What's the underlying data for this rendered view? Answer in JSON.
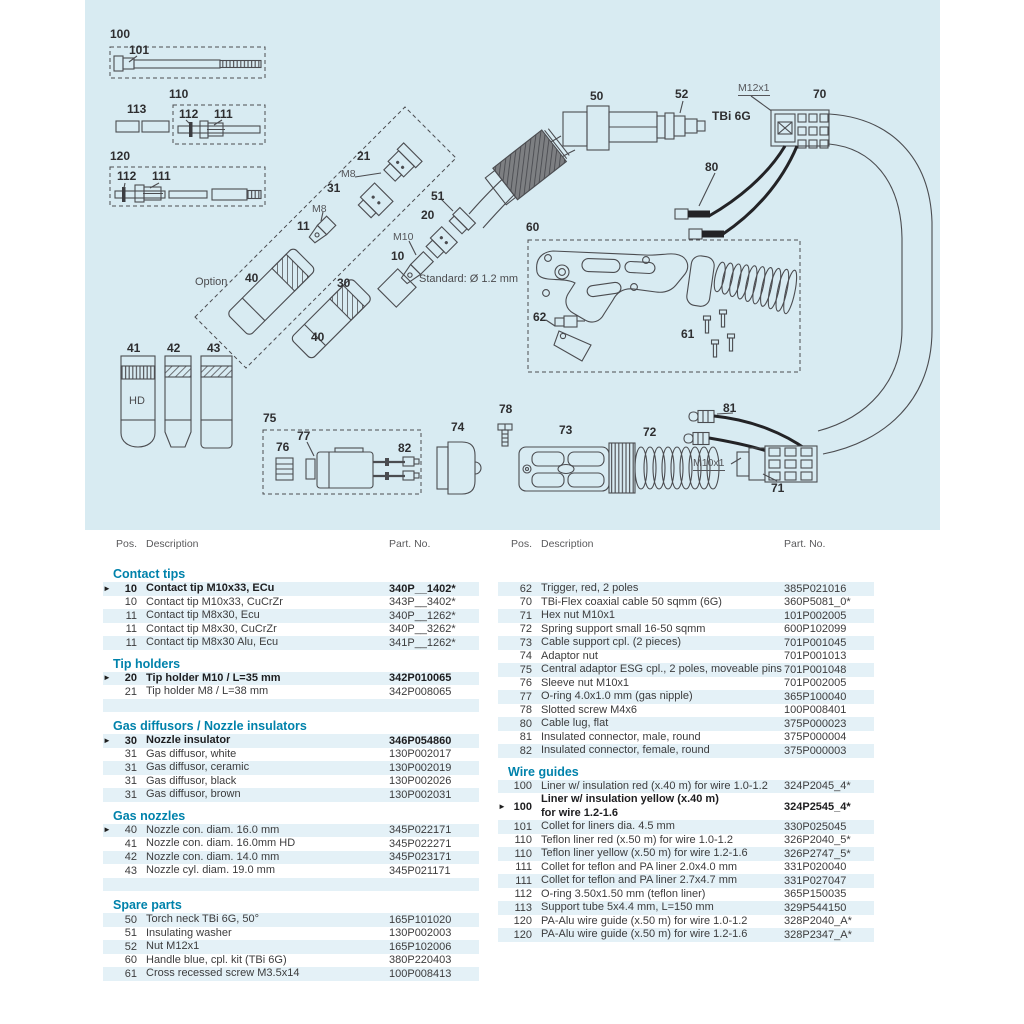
{
  "colors": {
    "panel_bg": "#d8ebf2",
    "accent": "#0082ab",
    "row_shade": "#e4f1f7",
    "line": "#4b4c50",
    "text": "#3c3c3d"
  },
  "arrow_char": "►",
  "diagram": {
    "labels": [
      {
        "text": "100",
        "x": 25,
        "y": 28,
        "cls": "b"
      },
      {
        "text": "101",
        "x": 44,
        "y": 44,
        "cls": "b"
      },
      {
        "text": "113",
        "x": 42,
        "y": 103,
        "cls": "b"
      },
      {
        "text": "110",
        "x": 84,
        "y": 88,
        "cls": "b"
      },
      {
        "text": "112",
        "x": 94,
        "y": 108,
        "cls": "b"
      },
      {
        "text": "111",
        "x": 129,
        "y": 108,
        "cls": "b"
      },
      {
        "text": "120",
        "x": 25,
        "y": 150,
        "cls": "b"
      },
      {
        "text": "112",
        "x": 32,
        "y": 170,
        "cls": "b"
      },
      {
        "text": "111",
        "x": 67,
        "y": 170,
        "cls": "b"
      },
      {
        "text": "21",
        "x": 272,
        "y": 150,
        "cls": "b"
      },
      {
        "text": "M8",
        "x": 256,
        "y": 169,
        "cls": "s"
      },
      {
        "text": "31",
        "x": 242,
        "y": 182,
        "cls": "b"
      },
      {
        "text": "M8",
        "x": 227,
        "y": 204,
        "cls": "s"
      },
      {
        "text": "11",
        "x": 212,
        "y": 220,
        "cls": "b"
      },
      {
        "text": "Option",
        "x": 110,
        "y": 277,
        "cls": "g"
      },
      {
        "text": "40",
        "x": 160,
        "y": 272,
        "cls": "b"
      },
      {
        "text": "30",
        "x": 252,
        "y": 277,
        "cls": "b"
      },
      {
        "text": "40",
        "x": 226,
        "y": 331,
        "cls": "b"
      },
      {
        "text": "10",
        "x": 306,
        "y": 250,
        "cls": "b"
      },
      {
        "text": "M10",
        "x": 308,
        "y": 232,
        "cls": "s"
      },
      {
        "text": "20",
        "x": 336,
        "y": 209,
        "cls": "b"
      },
      {
        "text": "51",
        "x": 346,
        "y": 190,
        "cls": "b"
      },
      {
        "text": "Standard: Ø 1.2 mm",
        "x": 334,
        "y": 274,
        "cls": "g"
      },
      {
        "text": "50",
        "x": 505,
        "y": 90,
        "cls": "b"
      },
      {
        "text": "52",
        "x": 590,
        "y": 88,
        "cls": "b"
      },
      {
        "text": "TBi 6G",
        "x": 627,
        "y": 110,
        "cls": "b"
      },
      {
        "text": "M12x1",
        "x": 653,
        "y": 83,
        "cls": "s u"
      },
      {
        "text": "70",
        "x": 728,
        "y": 88,
        "cls": "b"
      },
      {
        "text": "80",
        "x": 620,
        "y": 161,
        "cls": "b"
      },
      {
        "text": "60",
        "x": 441,
        "y": 221,
        "cls": "b"
      },
      {
        "text": "62",
        "x": 448,
        "y": 311,
        "cls": "b"
      },
      {
        "text": "61",
        "x": 596,
        "y": 328,
        "cls": "b"
      },
      {
        "text": "41",
        "x": 42,
        "y": 342,
        "cls": "b"
      },
      {
        "text": "42",
        "x": 82,
        "y": 342,
        "cls": "b"
      },
      {
        "text": "43",
        "x": 122,
        "y": 342,
        "cls": "b"
      },
      {
        "text": "HD",
        "x": 44,
        "y": 396,
        "cls": "g"
      },
      {
        "text": "75",
        "x": 178,
        "y": 412,
        "cls": "b"
      },
      {
        "text": "76",
        "x": 191,
        "y": 441,
        "cls": "b"
      },
      {
        "text": "77",
        "x": 212,
        "y": 430,
        "cls": "b"
      },
      {
        "text": "82",
        "x": 313,
        "y": 442,
        "cls": "b"
      },
      {
        "text": "74",
        "x": 366,
        "y": 421,
        "cls": "b"
      },
      {
        "text": "78",
        "x": 414,
        "y": 403,
        "cls": "b"
      },
      {
        "text": "73",
        "x": 474,
        "y": 424,
        "cls": "b"
      },
      {
        "text": "72",
        "x": 558,
        "y": 426,
        "cls": "b"
      },
      {
        "text": "81",
        "x": 638,
        "y": 402,
        "cls": "b"
      },
      {
        "text": "M10x1",
        "x": 608,
        "y": 458,
        "cls": "s u"
      },
      {
        "text": "71",
        "x": 686,
        "y": 482,
        "cls": "b"
      }
    ]
  },
  "tables": {
    "header": {
      "pos": "Pos.",
      "desc": "Description",
      "part": "Part. No."
    },
    "left": {
      "sections": [
        {
          "title": "Contact tips",
          "rows": [
            {
              "pos": "10",
              "desc": "Contact tip M10x33, ECu",
              "part": "340P__1402*",
              "bold": true,
              "arrow": true,
              "shaded": true
            },
            {
              "pos": "10",
              "desc": "Contact tip M10x33, CuCrZr",
              "part": "343P__3402*"
            },
            {
              "pos": "11",
              "desc": "Contact tip M8x30, Ecu",
              "part": "340P__1262*",
              "shaded": true
            },
            {
              "pos": "11",
              "desc": "Contact tip M8x30, CuCrZr",
              "part": "340P__3262*"
            },
            {
              "pos": "11",
              "desc": "Contact tip M8x30 Alu, Ecu",
              "part": "341P__1262*",
              "shaded": true
            }
          ]
        },
        {
          "title": "Tip holders",
          "rows": [
            {
              "pos": "20",
              "desc": "Tip holder M10 / L=35 mm",
              "part": "342P010065",
              "bold": true,
              "arrow": true,
              "shaded": true
            },
            {
              "pos": "21",
              "desc": "Tip holder M8 / L=38 mm",
              "part": "342P008065"
            },
            {
              "empty": true,
              "shaded": true
            }
          ]
        },
        {
          "title": "Gas diffusors / Nozzle insulators",
          "rows": [
            {
              "pos": "30",
              "desc": "Nozzle insulator",
              "part": "346P054860",
              "bold": true,
              "arrow": true,
              "shaded": true
            },
            {
              "pos": "31",
              "desc": "Gas diffusor, white",
              "part": "130P002017"
            },
            {
              "pos": "31",
              "desc": "Gas diffusor, ceramic",
              "part": "130P002019",
              "shaded": true
            },
            {
              "pos": "31",
              "desc": "Gas diffusor, black",
              "part": "130P002026"
            },
            {
              "pos": "31",
              "desc": "Gas diffusor, brown",
              "part": "130P002031",
              "shaded": true
            }
          ]
        },
        {
          "title": "Gas nozzles",
          "rows": [
            {
              "pos": "40",
              "desc": "Nozzle con. diam. 16.0 mm",
              "part": "345P022171",
              "arrow": true,
              "shaded": true
            },
            {
              "pos": "41",
              "desc": "Nozzle con. diam. 16.0mm HD",
              "part": "345P022271"
            },
            {
              "pos": "42",
              "desc": "Nozzle con. diam. 14.0 mm",
              "part": "345P023171",
              "shaded": true
            },
            {
              "pos": "43",
              "desc": "Nozzle cyl. diam. 19.0 mm",
              "part": "345P021171"
            },
            {
              "empty": true,
              "shaded": true
            }
          ]
        },
        {
          "title": "Spare parts",
          "rows": [
            {
              "pos": "50",
              "desc": "Torch neck TBi 6G, 50°",
              "part": "165P101020",
              "shaded": true
            },
            {
              "pos": "51",
              "desc": "Insulating washer",
              "part": "130P002003"
            },
            {
              "pos": "52",
              "desc": "Nut M12x1",
              "part": "165P102006",
              "shaded": true
            },
            {
              "pos": "60",
              "desc": "Handle blue, cpl. kit (TBi 6G)",
              "part": "380P220403"
            },
            {
              "pos": "61",
              "desc": "Cross recessed screw M3.5x14",
              "part": "100P008413",
              "shaded": true
            }
          ]
        }
      ]
    },
    "right": {
      "sections": [
        {
          "title": "",
          "rows": [
            {
              "pos": "62",
              "desc": "Trigger, red, 2 poles",
              "part": "385P021016",
              "shaded": true
            },
            {
              "pos": "70",
              "desc": "TBi-Flex coaxial cable 50 sqmm (6G)",
              "part": "360P5081_0*"
            },
            {
              "pos": "71",
              "desc": "Hex nut M10x1",
              "part": "101P002005",
              "shaded": true
            },
            {
              "pos": "72",
              "desc": "Spring support small 16-50 sqmm",
              "part": "600P102099"
            },
            {
              "pos": "73",
              "desc": "Cable support cpl. (2 pieces)",
              "part": "701P001045",
              "shaded": true
            },
            {
              "pos": "74",
              "desc": "Adaptor nut",
              "part": "701P001013"
            },
            {
              "pos": "75",
              "desc": "Central adaptor ESG cpl., 2 poles, moveable pins",
              "part": "701P001048",
              "shaded": true
            },
            {
              "pos": "76",
              "desc": "Sleeve nut M10x1",
              "part": "701P002005"
            },
            {
              "pos": "77",
              "desc": "O-ring  4.0x1.0 mm (gas nipple)",
              "part": "365P100040",
              "shaded": true
            },
            {
              "pos": "78",
              "desc": "Slotted screw M4x6",
              "part": "100P008401"
            },
            {
              "pos": "80",
              "desc": "Cable lug, flat",
              "part": "375P000023",
              "shaded": true
            },
            {
              "pos": "81",
              "desc": "Insulated connector, male, round",
              "part": "375P000004"
            },
            {
              "pos": "82",
              "desc": "Insulated connector, female, round",
              "part": "375P000003",
              "shaded": true
            }
          ]
        },
        {
          "title": "Wire guides",
          "rows": [
            {
              "pos": "100",
              "desc": "Liner w/ insulation red (x.40 m) for wire 1.0-1.2",
              "part": "324P2045_4*",
              "shaded": true
            },
            {
              "pos": "100",
              "desc": "Liner w/ insulation yellow (x.40 m)",
              "desc2": "for wire 1.2-1.6",
              "part": "324P2545_4*",
              "bold": true,
              "arrow": true
            },
            {
              "pos": "101",
              "desc": "Collet for liners dia. 4.5 mm",
              "part": "330P025045",
              "shaded": true
            },
            {
              "pos": "110",
              "desc": "Teflon liner red  (x.50 m)  for wire 1.0-1.2",
              "part": "326P2040_5*"
            },
            {
              "pos": "110",
              "desc": "Teflon liner yellow (x.50 m) for wire 1.2-1.6",
              "part": "326P2747_5*",
              "shaded": true
            },
            {
              "pos": "111",
              "desc": "Collet for teflon and PA liner 2.0x4.0 mm",
              "part": "331P020040"
            },
            {
              "pos": "111",
              "desc": "Collet for teflon and PA liner 2.7x4.7 mm",
              "part": "331P027047",
              "shaded": true
            },
            {
              "pos": "112",
              "desc": "O-ring  3.50x1.50 mm (teflon liner)",
              "part": "365P150035"
            },
            {
              "pos": "113",
              "desc": "Support tube 5x4.4 mm, L=150 mm",
              "part": "329P544150",
              "shaded": true
            },
            {
              "pos": "120",
              "desc": "PA-Alu wire guide (x.50 m) for wire 1.0-1.2",
              "part": "328P2040_A*"
            },
            {
              "pos": "120",
              "desc": "PA-Alu wire guide (x.50 m) for wire 1.2-1.6",
              "part": "328P2347_A*",
              "shaded": true
            }
          ]
        }
      ]
    }
  }
}
